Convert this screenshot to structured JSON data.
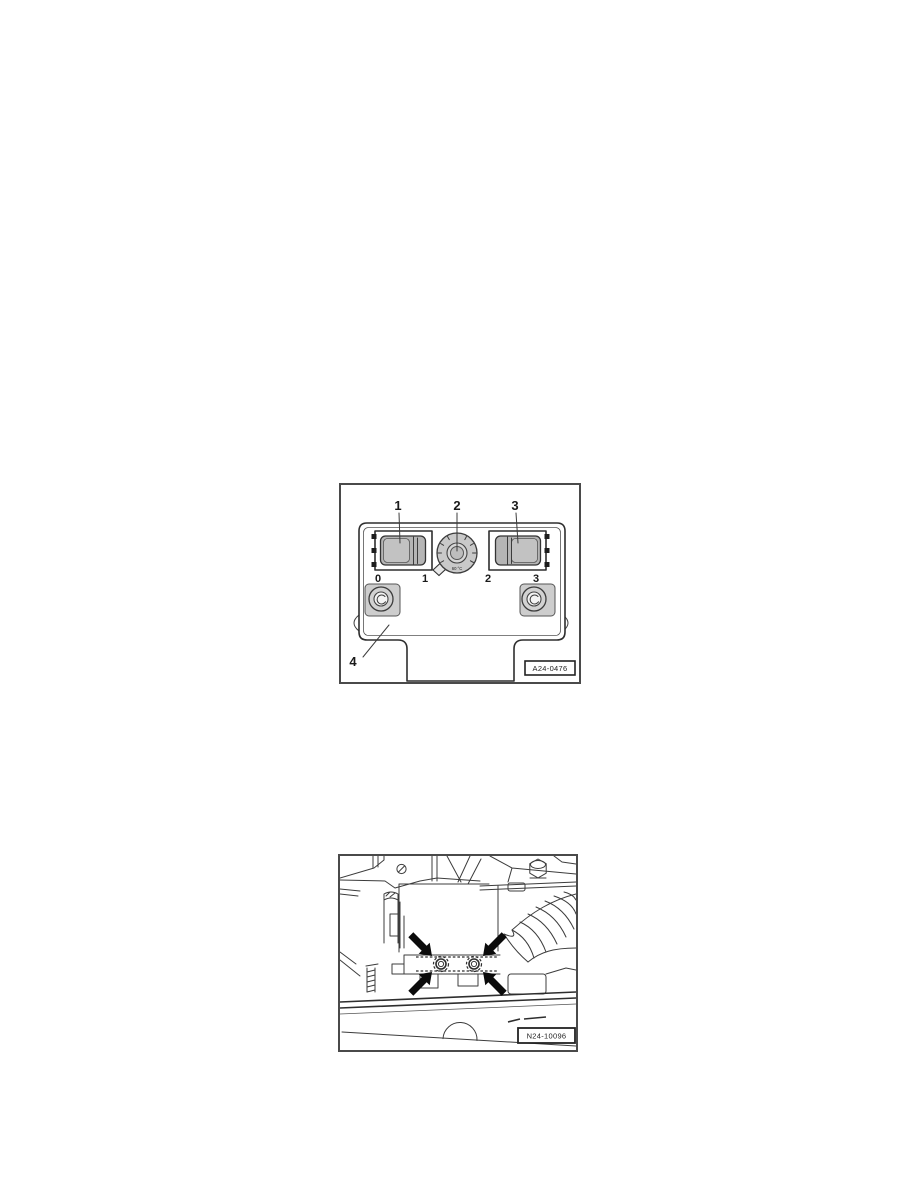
{
  "figure1": {
    "code": "A24-0476",
    "callouts": [
      "1",
      "2",
      "3",
      "4"
    ],
    "switch_positions": [
      "0",
      "1",
      "2",
      "3"
    ],
    "dial_text": "60 °C"
  },
  "figure2": {
    "code": "N24-10096"
  },
  "colors": {
    "page_background": "#ffffff",
    "line": "#3c3c3c",
    "frame_border": "#4a4a4a",
    "switch_fill": "#b5b5b5",
    "dial_fill": "#c9c9c9",
    "arrow_black": "#0b0b0b"
  }
}
